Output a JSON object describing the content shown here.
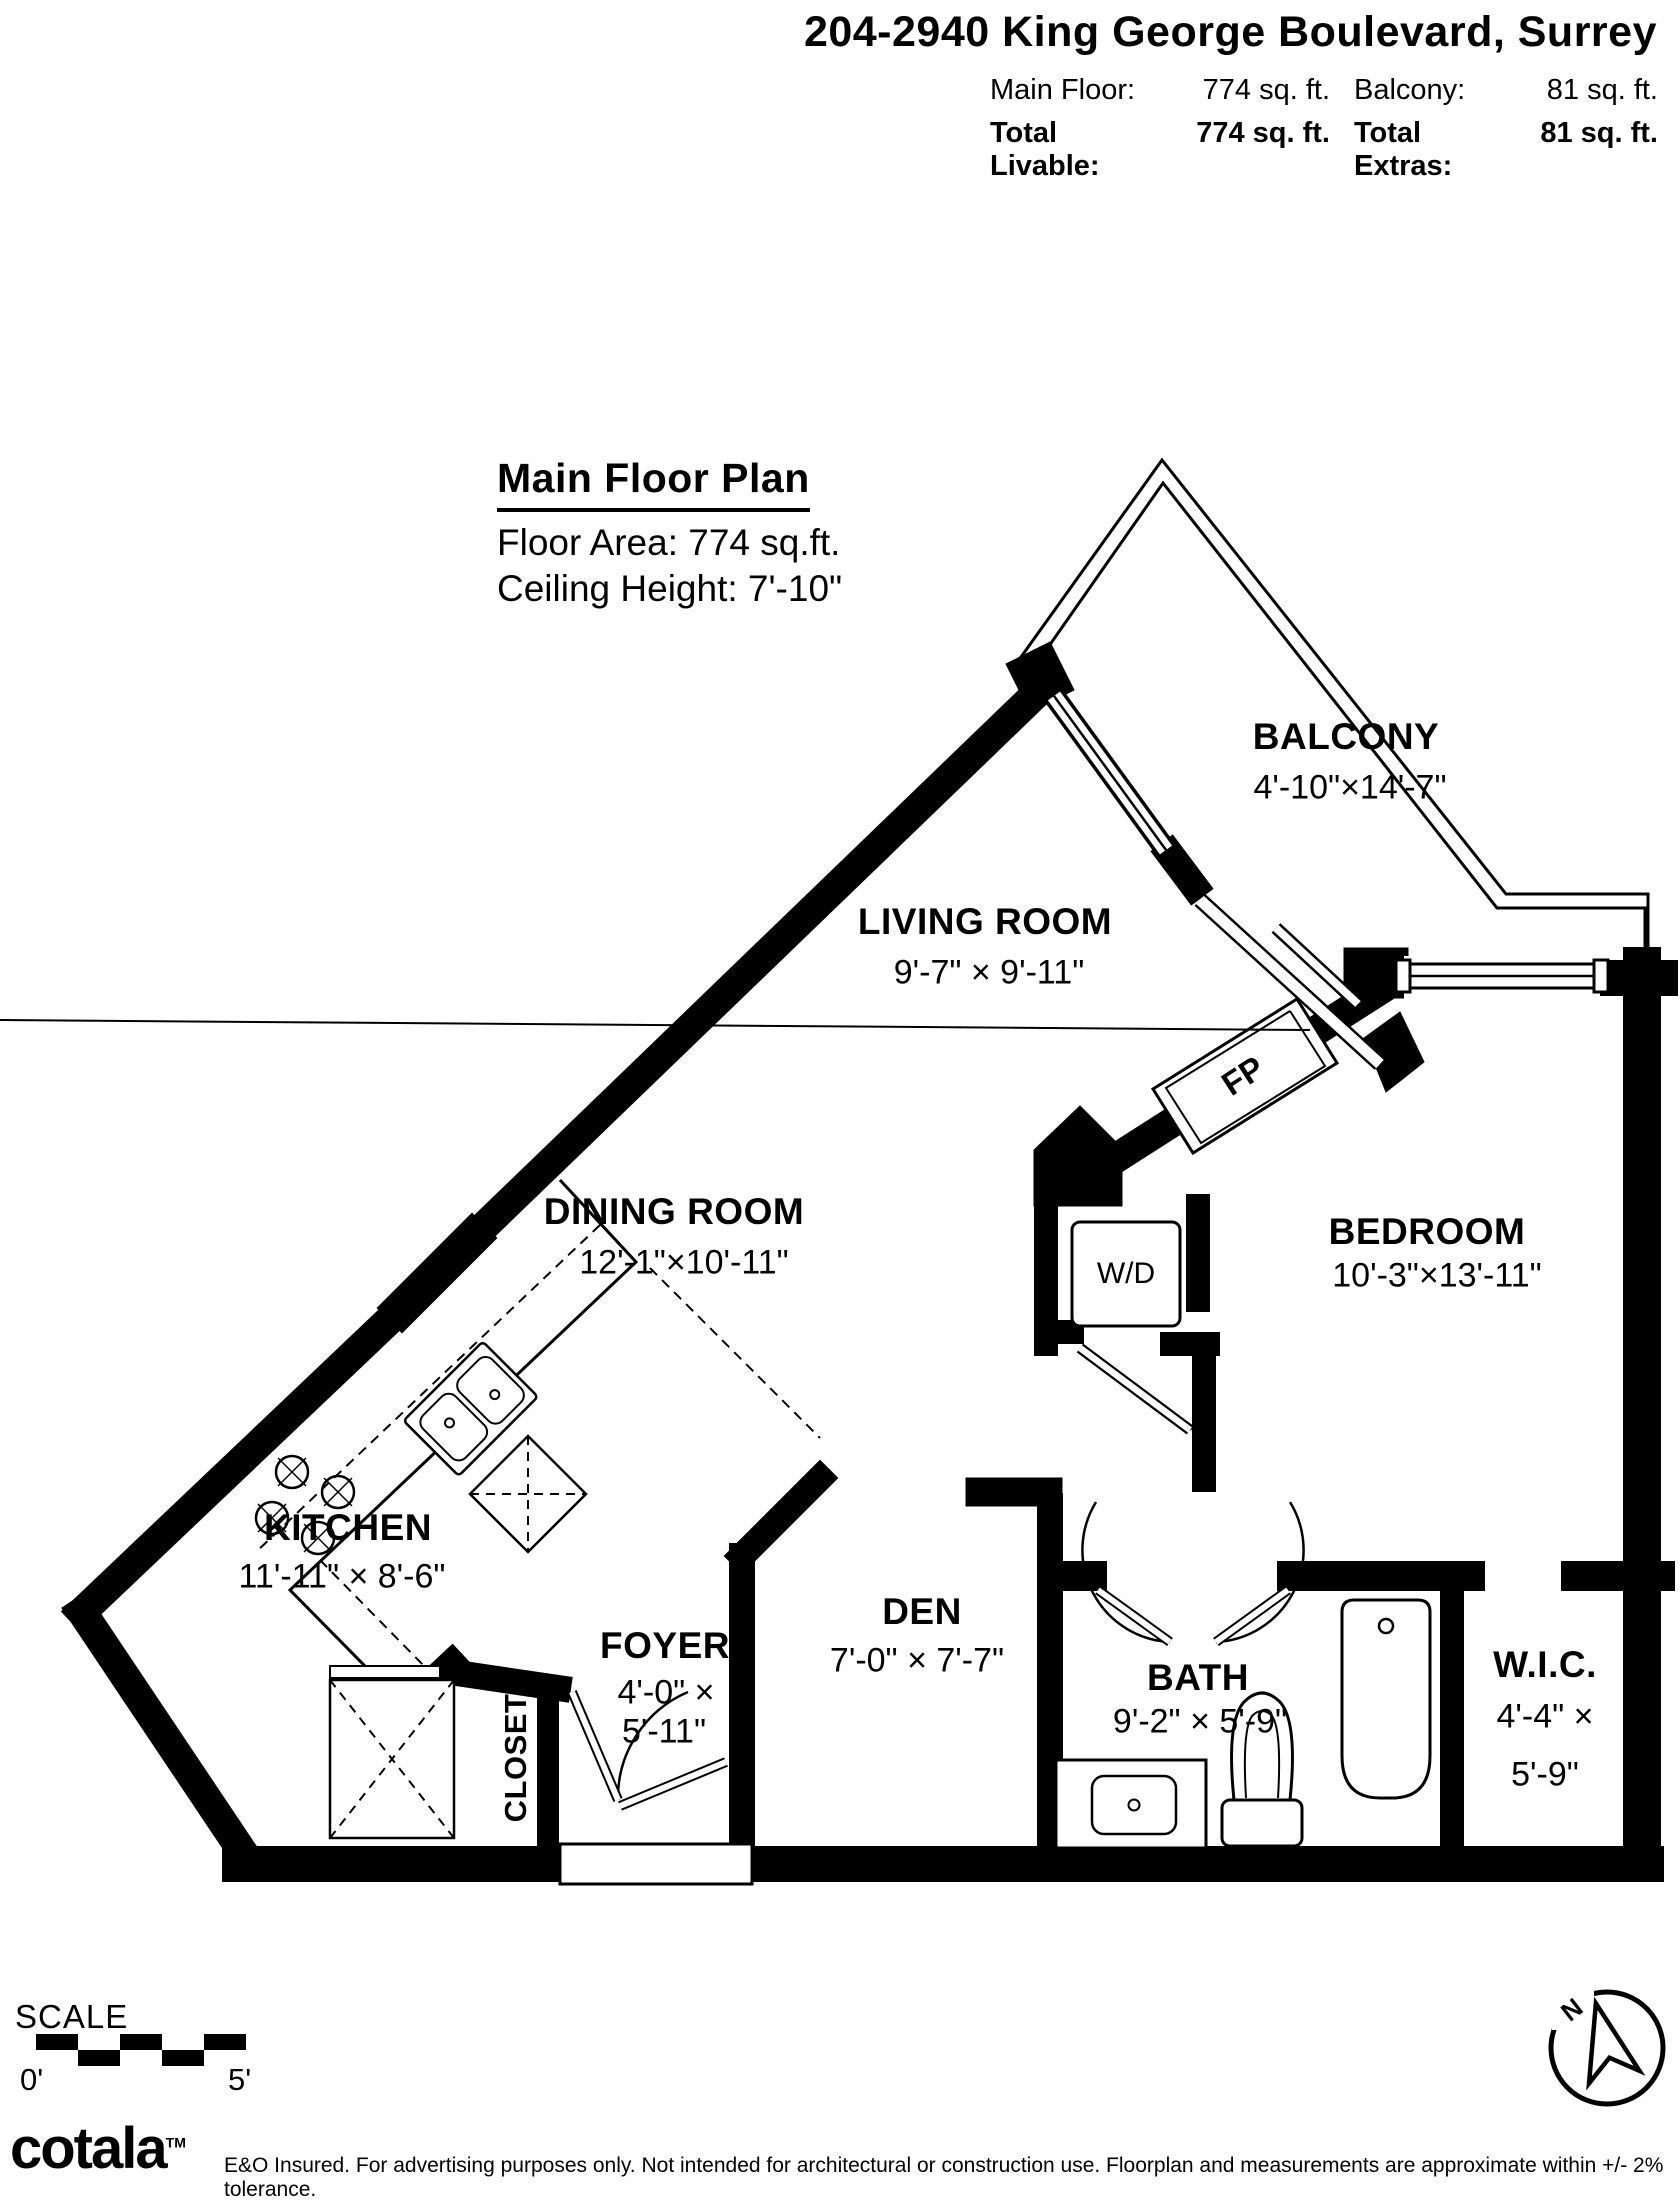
{
  "header": {
    "title": "204-2940 King George Boulevard, Surrey",
    "stats": {
      "main_floor_label": "Main Floor:",
      "main_floor_value": "774 sq. ft.",
      "balcony_label": "Balcony:",
      "balcony_value": "81 sq. ft.",
      "total_livable_label": "Total Livable:",
      "total_livable_value": "774 sq. ft.",
      "total_extras_label": "Total Extras:",
      "total_extras_value": "81 sq. ft."
    }
  },
  "plan": {
    "title": "Main Floor Plan",
    "floor_area": "Floor Area: 774 sq.ft.",
    "ceiling_height": "Ceiling Height: 7'-10\""
  },
  "rooms": {
    "balcony": {
      "name": "BALCONY",
      "dims": "4'-10\"×14'-7\""
    },
    "living": {
      "name": "LIVING ROOM",
      "dims": "9'-7\" × 9'-11\""
    },
    "dining": {
      "name": "DINING ROOM",
      "dims": "12'-1\"×10'-11\""
    },
    "bedroom": {
      "name": "BEDROOM",
      "dims": "10'-3\"×13'-11\""
    },
    "kitchen": {
      "name": "KITCHEN",
      "dims": "11'-11\" × 8'-6\""
    },
    "den": {
      "name": "DEN",
      "dims": "7'-0\" × 7'-7\""
    },
    "foyer": {
      "name": "FOYER",
      "dims1": "4'-0\" ×",
      "dims2": "5'-11\""
    },
    "bath": {
      "name": "BATH",
      "dims": "9'-2\" × 5'-9\""
    },
    "wic": {
      "name": "W.I.C.",
      "dims1": "4'-4\" ×",
      "dims2": "5'-9\""
    },
    "closet": {
      "name": "CLOSET"
    }
  },
  "fixtures": {
    "washer_dryer": "W/D",
    "fireplace": "FP"
  },
  "scale": {
    "label": "SCALE",
    "start": "0'",
    "end": "5'"
  },
  "compass": {
    "north": "N"
  },
  "footer": {
    "brand": "cotala",
    "trademark": "TM",
    "disclaimer": "E&O Insured. For advertising purposes only. Not intended for architectural or construction use. Floorplan and measurements are approximate within +/- 2% tolerance."
  }
}
